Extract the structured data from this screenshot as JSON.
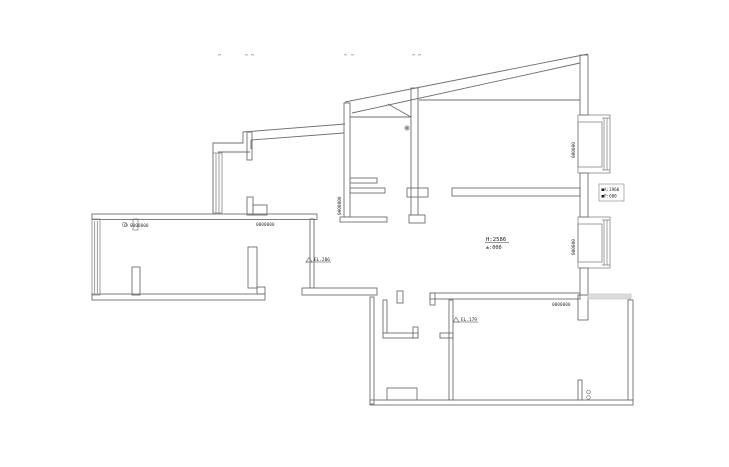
{
  "drawing": {
    "type": "cad-floor-plan",
    "colors": {
      "background": "#ffffff",
      "wall_line": "#6f6f6f",
      "annotation_text": "#3a3a3a",
      "faint_marks": "#c3c3c3",
      "shade_strip": "#dcdcdc"
    },
    "annotations": {
      "door_dim_left": "0000000",
      "door_dim_right": "0000000",
      "window_dim_kitchen": "0000000",
      "window_dim_bay1": "000000",
      "window_dim_bay2": "000000",
      "window_dim_bottom": "0000000",
      "height_label": {
        "line1": "H:2586",
        "line2": "±:000"
      },
      "level_marker_hall": "EL.206",
      "level_marker_room": "EL.179",
      "info_box": {
        "line1": "■A:1960",
        "line2": "■P:600"
      },
      "hinge_dots": "0 0"
    }
  }
}
